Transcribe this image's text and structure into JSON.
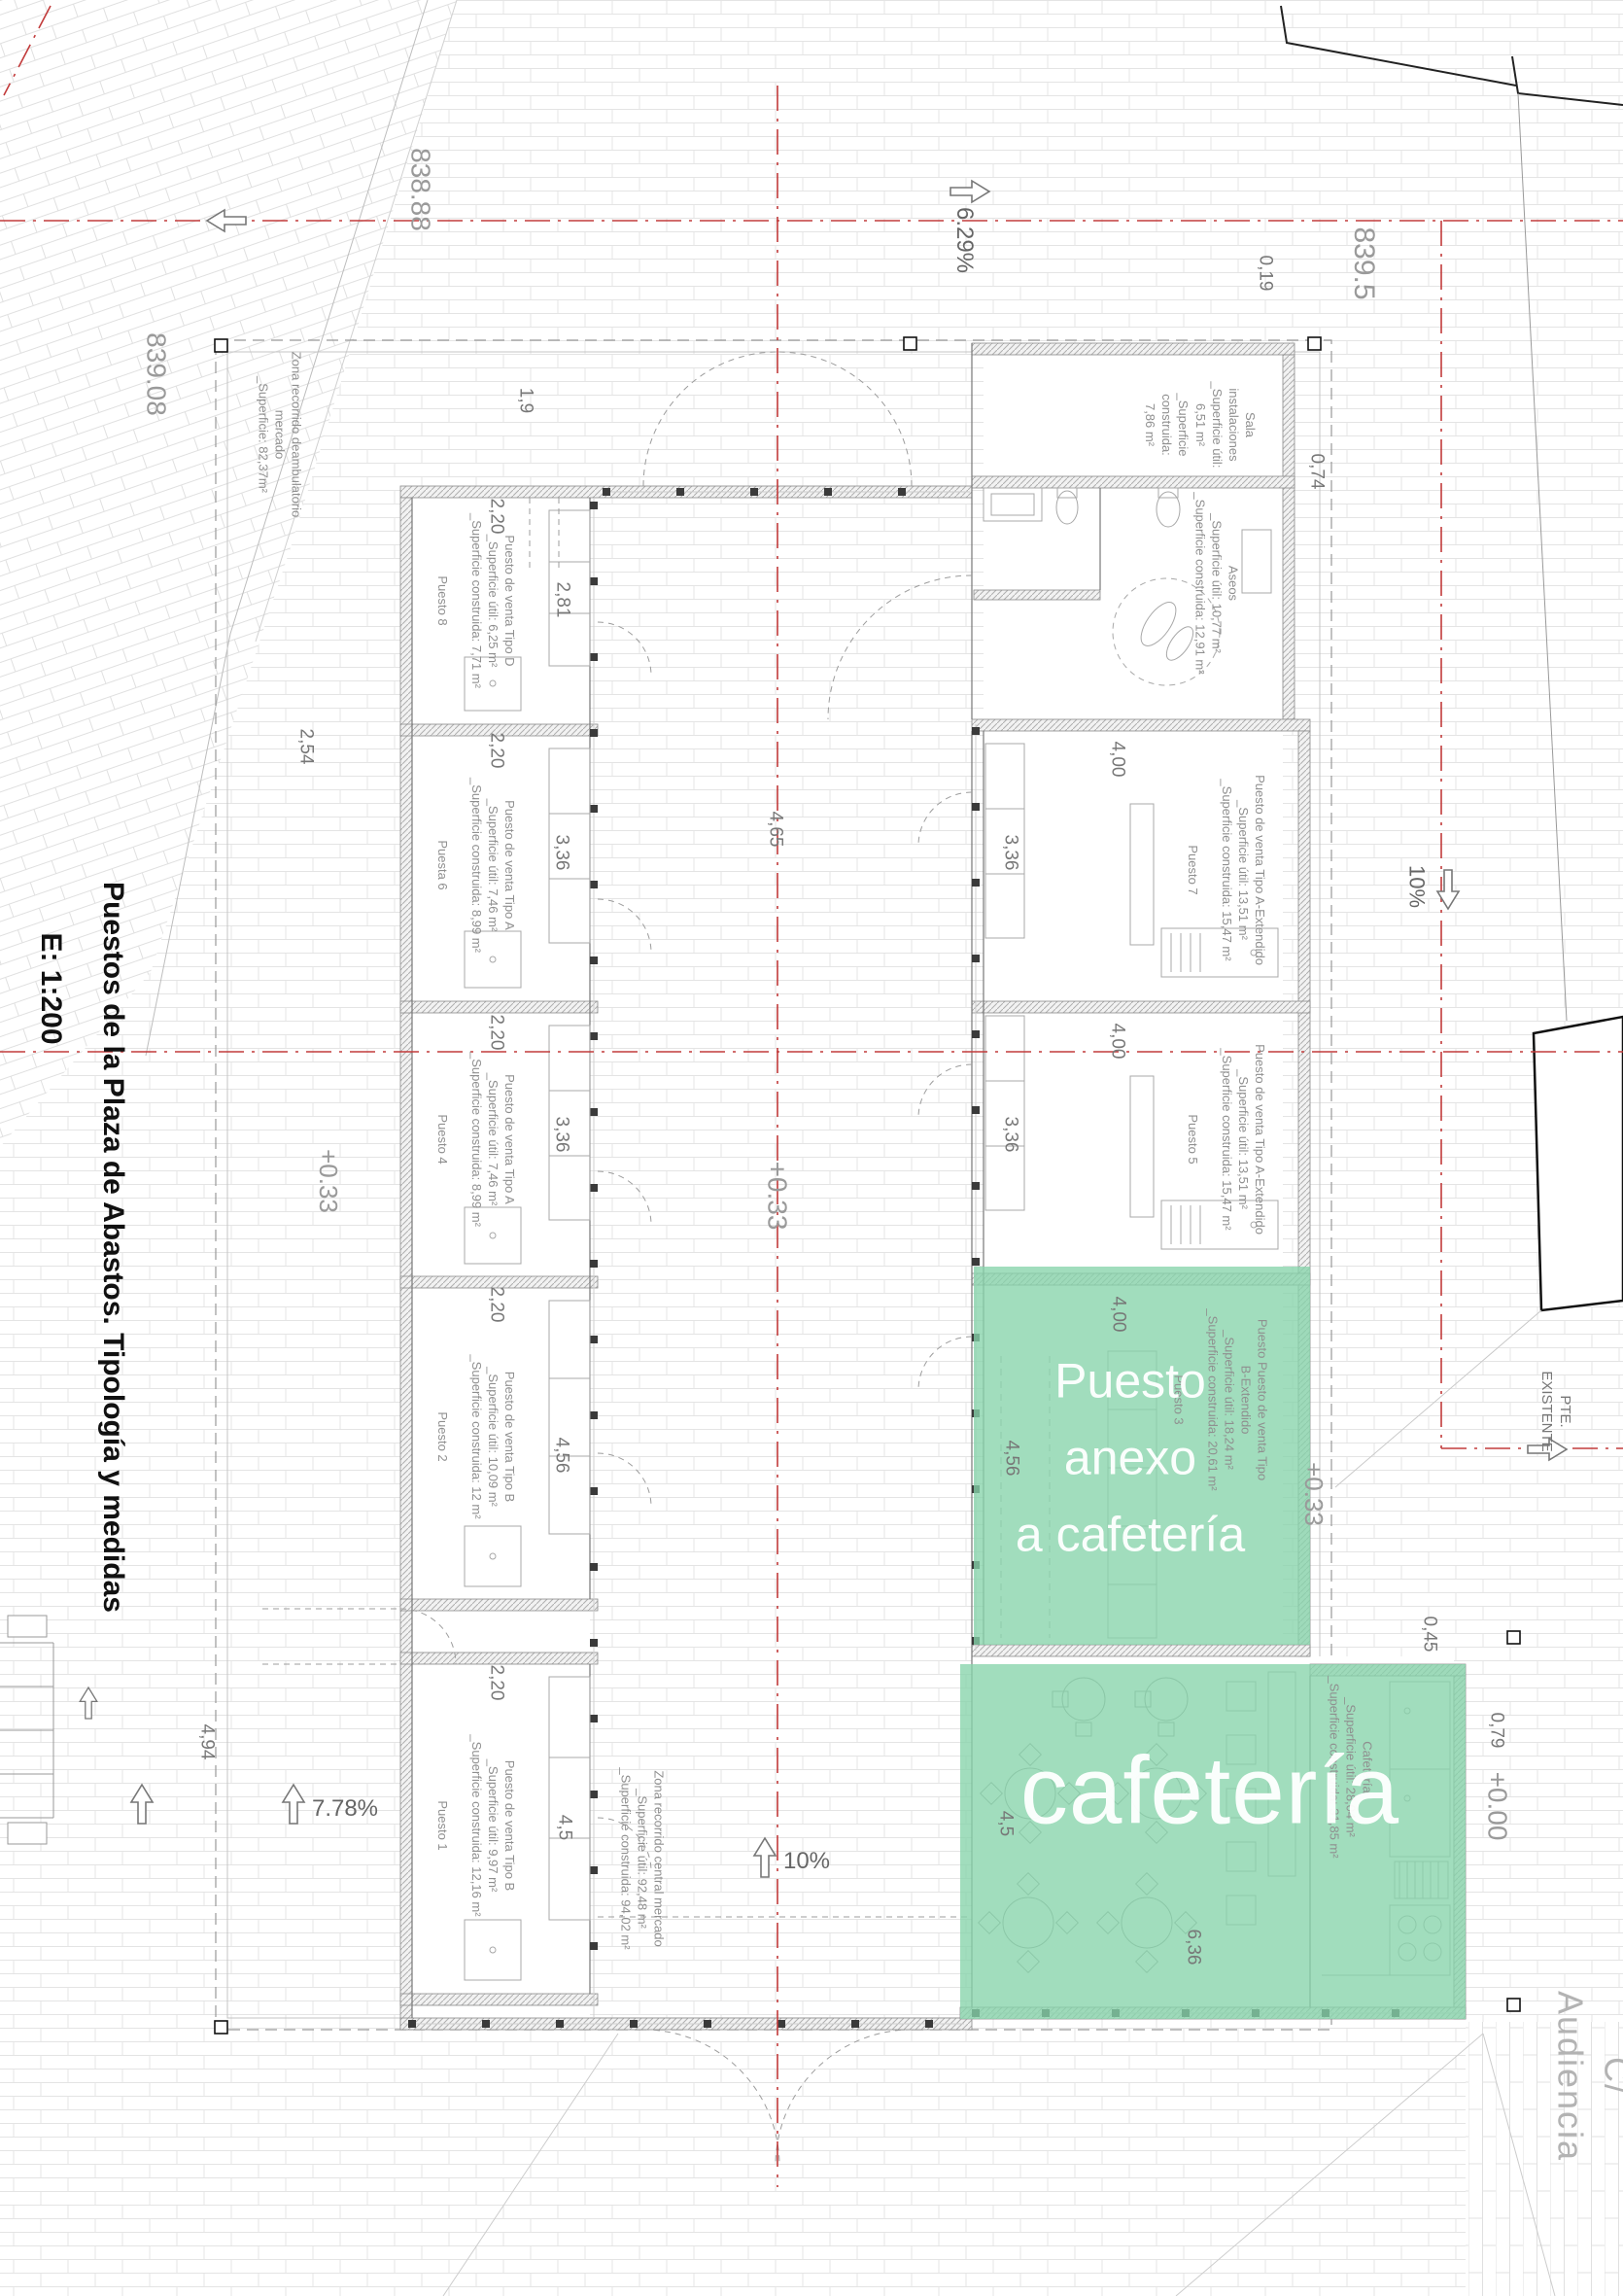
{
  "title": {
    "main": "Puestos de la Plaza de Abastos. Tipología y medidas",
    "scale": "E: 1:200"
  },
  "elevations": {
    "top_left": "838.88",
    "left": "839.08",
    "top_right": "839.5",
    "court_west": "+0.33",
    "court_center": "+0.33",
    "court_east": "+0.33",
    "street_level": "+0.00"
  },
  "street_name": "C/ Audiencia",
  "slopes": {
    "north": "6.29%",
    "east": "10%",
    "south": "10%",
    "west": "7.78%",
    "existing": "PTE.\nEXISTENTE"
  },
  "zones": {
    "perimeter": "Zona recorrido deambulatorio\nmercado\n_Superficie: 82,37m²",
    "central": "Zona recorrido central mercado\n_Superficie útil: 92,48 m²\n_Superficie construida: 94,02 m²"
  },
  "rooms": {
    "sala": "Sala\ninstalaciones\n_Superficie útil:\n6,51 m²\n_Superficie\nconstruida:\n7,86 m²",
    "aseos": "Aseos\n_Superficie útil: 10,77 m²\n_Superficie construida: 12,91 m²",
    "p8": "Puesto de venta Tipo D\n_Superficie útil: 6,25 m²\n_Superficie construida: 7,71 m²\n\nPuesto 8",
    "p6": "Puesto de venta Tipo A\n_Superficie útil: 7,46 m²\n_Superficie construida: 8,99 m²\n\nPuesta 6",
    "p4": "Puesto de venta Tipo A\n_Superficie útil: 7,46 m²\n_Superficie construida: 8,99 m²\n\nPuesto 4",
    "p2": "Puesto de venta Tipo B\n_Superficie útil: 10,09 m²\n_Superficie construida: 12 m²\n\nPuesto 2",
    "p1": "Puesto de venta Tipo B\n_Superficie útil: 9,97 m²\n_Superficie construida: 12,16 m²\n\nPuesto 1",
    "p7": "Puesto de venta Tipo A-Extendido\n_Superficie útil: 13,51 m²\n_Superficie construida: 15,47 m²\n\nPuesto 7",
    "p5": "Puesto de venta Tipo A-Extendido\n_Superficie útil: 13,51 m²\n_Superficie construida: 15,47 m²\n\nPuesto 5",
    "p3": "Puesto Puesto de venta Tipo\nB-Extendido\n_Superficie útil: 18,24 m²\n_Superficie construida: 20,61 m²\n\nPuesto 3",
    "cafeteria_info": "Cafetería\n_Superficie útil: 28,04 m²\n_Superficie construida: 31,85 m²"
  },
  "highlights": {
    "anexo": "Puesto\nanexo\na cafetería",
    "cafeteria": "cafetería"
  },
  "dims": {
    "d0_19": "0,19",
    "d0_45": "0,45",
    "d0_74": "0,74",
    "d0_79": "0,79",
    "d1_9": "1,9",
    "d2_20": "2,20",
    "d2_54": "2,54",
    "d2_81": "2,81",
    "d3_36": "3,36",
    "d4_00": "4,00",
    "d4_5": "4,5",
    "d4_56": "4,56",
    "d4_65": "4,65",
    "d4_94": "4,94",
    "d6_36": "6,36"
  },
  "colors": {
    "axis_red": "#c23b3b",
    "highlight_green": "#86d4ab",
    "wall_gray": "#666666"
  }
}
